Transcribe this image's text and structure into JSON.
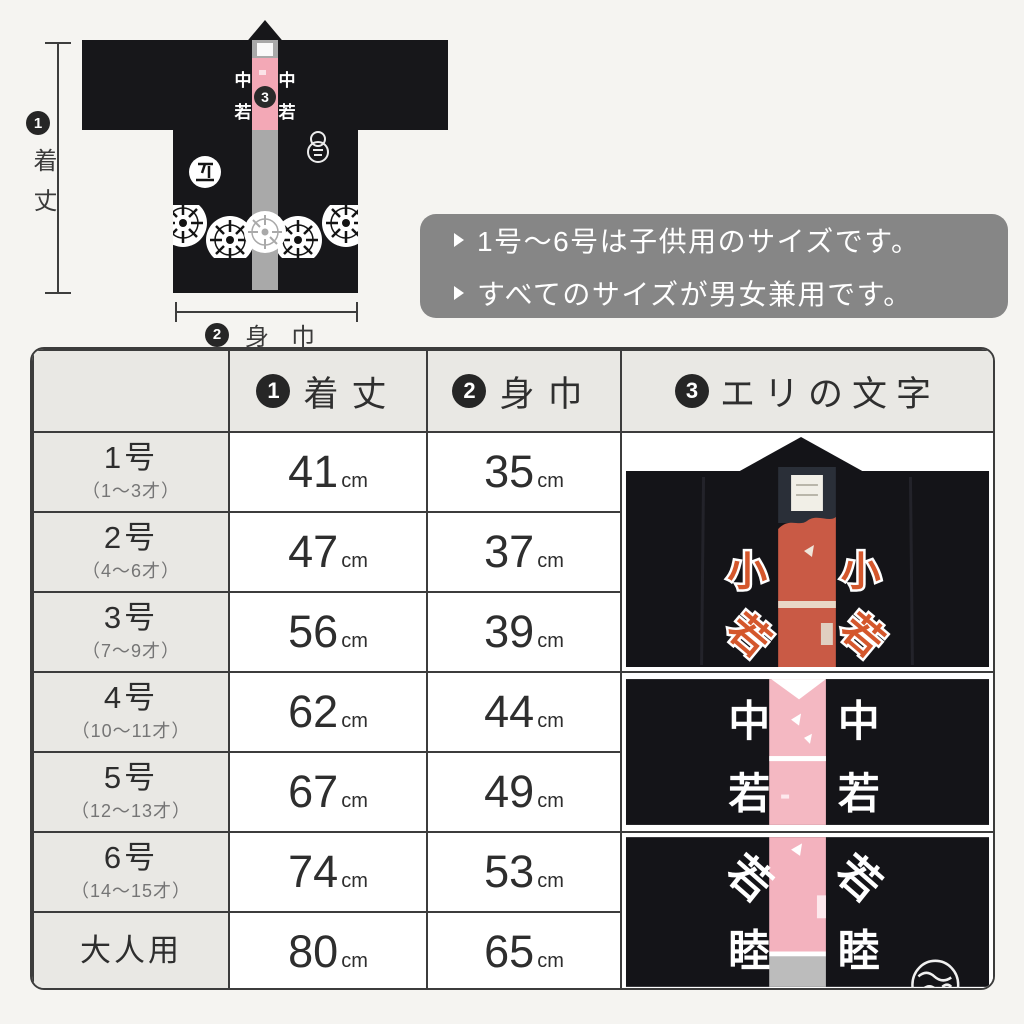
{
  "diagram": {
    "marker_length": "1",
    "marker_width": "2",
    "marker_collar": "3",
    "length_label": "着丈",
    "width_label": "身巾",
    "collar_top_char": "中",
    "collar_bottom_char": "若"
  },
  "notes": {
    "line1": "1号～6号は子供用のサイズです。",
    "line2": "すべてのサイズが男女兼用です。"
  },
  "table": {
    "header": {
      "col_length_marker": "1",
      "col_length_label": "着丈",
      "col_width_marker": "2",
      "col_width_label": "身巾",
      "col_collar_marker": "3",
      "col_collar_label": "エリの文字"
    },
    "unit": "cm",
    "rows": [
      {
        "size": "1号",
        "age": "（1～3才）",
        "length": "41",
        "width": "35"
      },
      {
        "size": "2号",
        "age": "（4～6才）",
        "length": "47",
        "width": "37"
      },
      {
        "size": "3号",
        "age": "（7～9才）",
        "length": "56",
        "width": "39"
      },
      {
        "size": "4号",
        "age": "（10～11才）",
        "length": "62",
        "width": "44"
      },
      {
        "size": "5号",
        "age": "（12～13才）",
        "length": "67",
        "width": "49"
      },
      {
        "size": "6号",
        "age": "（14～15才）",
        "length": "74",
        "width": "53"
      },
      {
        "size": "大人用",
        "age": "",
        "length": "80",
        "width": "65"
      }
    ],
    "collar_samples": [
      {
        "top_char": "小",
        "bottom_char": "若"
      },
      {
        "top_char": "中",
        "bottom_char": "若"
      },
      {
        "top_char": "若",
        "bottom_char": "睦"
      }
    ]
  },
  "colors": {
    "page_bg": "#f5f4f1",
    "jacket_black": "#17171a",
    "collar_gray": "#a9a9a9",
    "collar_pink": "#f3a8b6",
    "sample1_red": "#c95a45",
    "sample1_char_orange": "#d4572c",
    "sample2_pink": "#f4b8c2",
    "note_box_gray": "#868686",
    "table_border": "#3c3c3c",
    "cell_gray": "#e9e8e4"
  }
}
